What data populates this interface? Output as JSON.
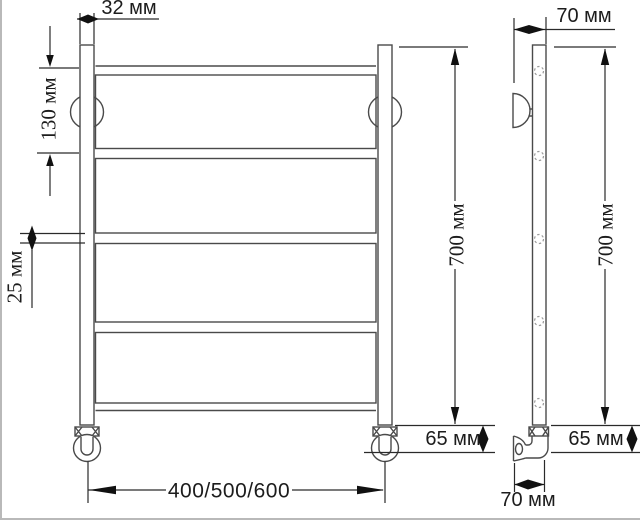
{
  "title": "Чертёж полотенцесушителя (лесенка): вид спереди и сбоку",
  "drawing": {
    "front_view": "front elevation of ladder towel rail",
    "side_view": "side elevation with wall bracket and elbow valve",
    "line_color": "#4a4a4a",
    "dim_color": "#2a2a2a",
    "background": "#ffffff"
  },
  "dimensions": {
    "tube_width": "32 мм",
    "top_rung_offset": "130 мм",
    "rung_thickness": "25 мм",
    "height_front": "700 мм",
    "height_side": "700 мм",
    "wall_offset_top": "70 мм",
    "foot_height_front": "65 мм",
    "foot_height_side": "65 мм",
    "width_options": "400/500/600",
    "wall_offset_bottom": "70 мм"
  }
}
